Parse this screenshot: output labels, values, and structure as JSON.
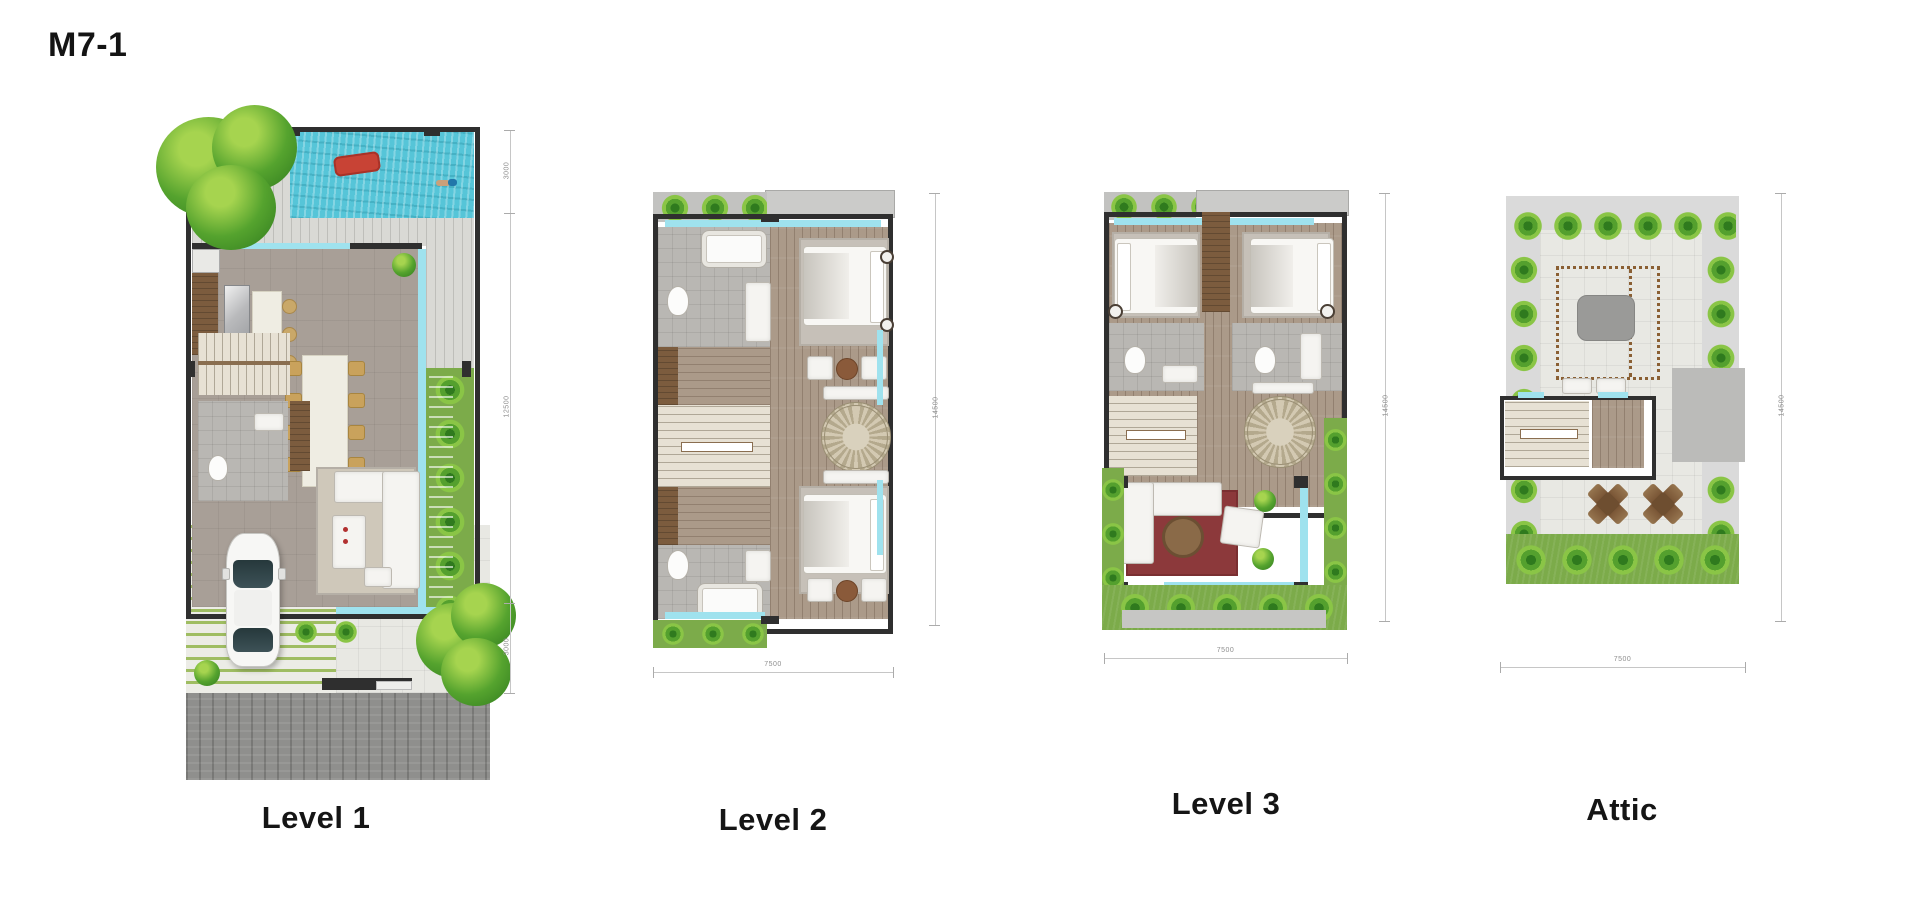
{
  "page": {
    "title": "M7-1"
  },
  "plans": [
    {
      "id": "level-1",
      "label": "Level 1",
      "dimensions_right": [
        "3000",
        "12500",
        "3000"
      ]
    },
    {
      "id": "level-2",
      "label": "Level 2",
      "dimension_bottom": "7500",
      "dimension_right": "14500"
    },
    {
      "id": "level-3",
      "label": "Level 3",
      "dimension_bottom": "7500",
      "dimension_right": "14500"
    },
    {
      "id": "attic",
      "label": "Attic",
      "dimension_bottom": "7500",
      "dimension_right": "14500"
    }
  ],
  "colors": {
    "pool_water": "#56c5d8",
    "water_edge": "#9fe2ee",
    "grass": "#7cab4a",
    "plant_green": "#54a02e",
    "wall": "#2f2f2f",
    "wood_floor": "#ab9a89",
    "red_rug": "#8c393b",
    "street_pavement": "#8f8f8d"
  }
}
